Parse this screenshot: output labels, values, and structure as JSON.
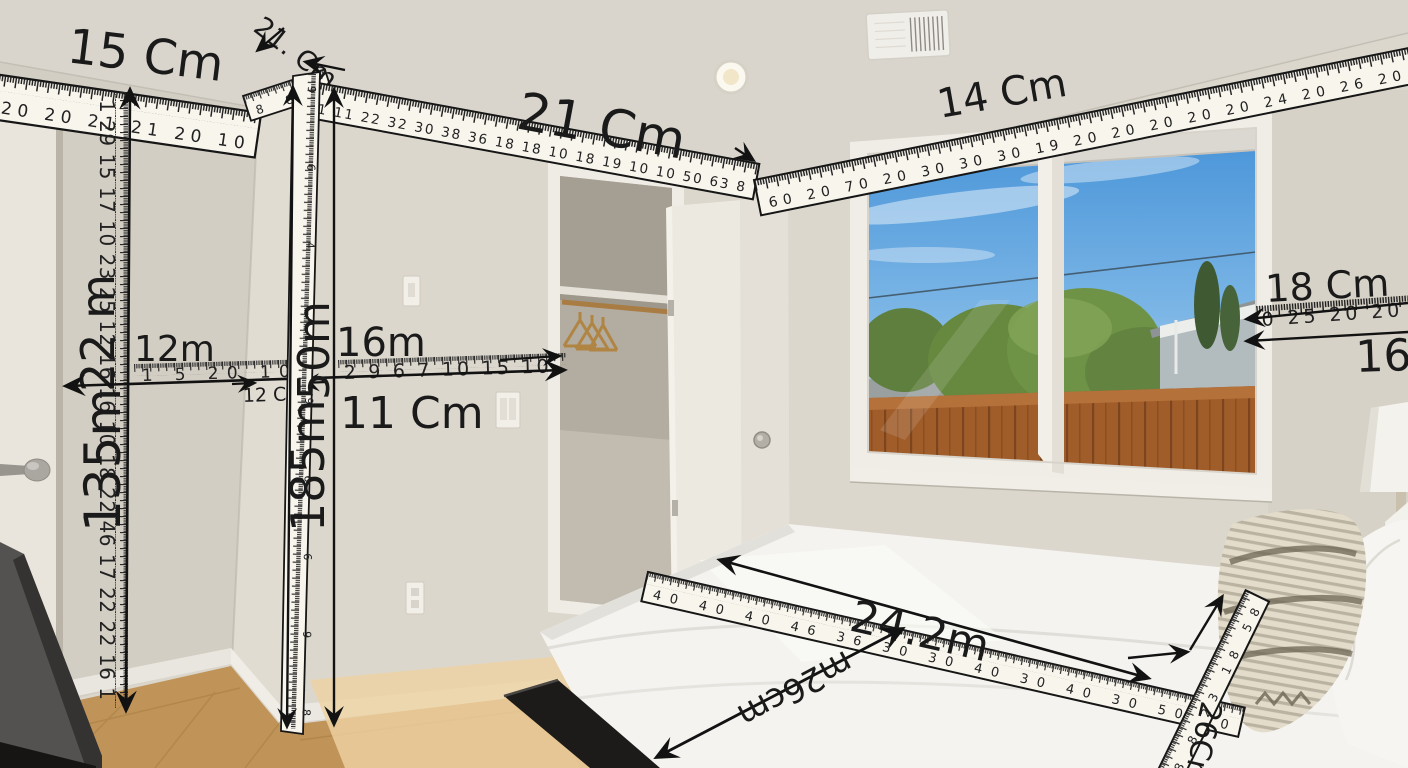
{
  "measurements": {
    "top_left_wall": {
      "label": "15 Cm",
      "ticks": "20 20 21 21 20 10"
    },
    "corner_top": {
      "label": "21. Cm",
      "ticks": "8 8 8"
    },
    "top_center": {
      "label": "21 Cm",
      "ticks": "11 11 22 32 30 38 36 18 18 10 18 19 10 10 50 63 8"
    },
    "top_right": {
      "label": "14 Cm",
      "ticks": "60 20 70 20 30 30 30 19 20 20 20 20 20 24 20 26 20"
    },
    "left_height_upper": {
      "label": "22 m"
    },
    "left_height_lower": {
      "label": "135m"
    },
    "left_vertical_ticks": "1 29 15 17 10 23 25 12 16 16 10 18 22 46 17 22 22 16 1",
    "left_horizontal": {
      "label": "12m",
      "ticks": "1 5 20 10"
    },
    "corner_gap": {
      "label": "12 Cm"
    },
    "mid_horizontal": {
      "label": "16m",
      "ticks": "2 9 6 7 10 15 10"
    },
    "mid_horizontal_below": {
      "label": "11 Cm"
    },
    "corner_height_upper": {
      "label": "50m"
    },
    "corner_height_lower": {
      "label": "185m"
    },
    "corner_vertical_ticks": "9 6 4 4 9 6 6 9 8",
    "right_wall": {
      "label": "18 Cm",
      "ticks": "0 25 20 20"
    },
    "right_wall_below": {
      "label": "16m"
    },
    "bed_length": {
      "label": "24.2m",
      "ticks": "40 40 40 46 36 30 30 40 30 40 30 50 30"
    },
    "bed_width": {
      "label": "m26cm"
    },
    "bed_edge": {
      "label": "26Cm",
      "ticks": "8 8 23 18 58"
    }
  }
}
